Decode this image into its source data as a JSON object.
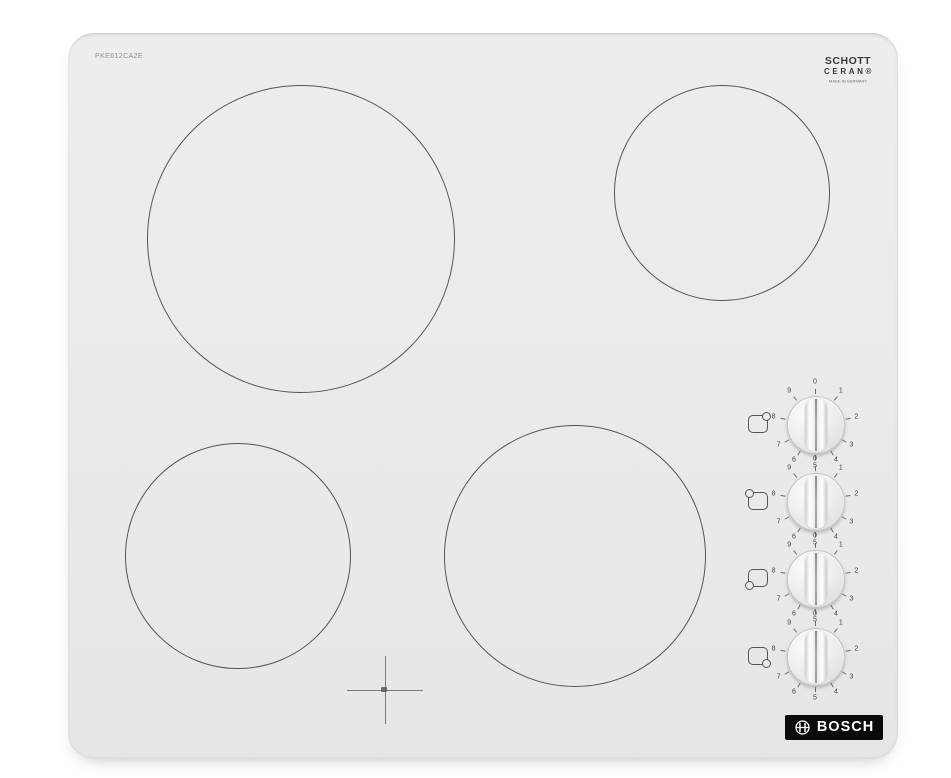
{
  "product": {
    "model_code": "PKE612CA2E",
    "type": "ceramic glass cooktop"
  },
  "branding": {
    "schott": {
      "line1": "SCHOTT",
      "line2": "CERAN®",
      "subtext": "MADE IN GERMANY"
    },
    "bosch": {
      "label": "BOSCH"
    }
  },
  "colors": {
    "page_bg": "#ffffff",
    "hob_surface": "#e9eae9",
    "zone_outline": "#303030",
    "dial_text": "#414141",
    "logo_bg": "#0b0b0b",
    "logo_text": "#ffffff"
  },
  "dial": {
    "numbers": [
      "0",
      "1",
      "2",
      "3",
      "4",
      "5",
      "6",
      "7",
      "8",
      "9"
    ],
    "angles_deg": [
      0,
      38,
      80,
      120,
      150,
      180,
      210,
      240,
      280,
      322
    ],
    "off_label": "0"
  },
  "knobs": [
    {
      "zone": "back right",
      "indicator_corner": "top-right",
      "position": "0"
    },
    {
      "zone": "back left",
      "indicator_corner": "top-left",
      "position": "0"
    },
    {
      "zone": "front left",
      "indicator_corner": "bottom-left",
      "position": "0"
    },
    {
      "zone": "front right",
      "indicator_corner": "bottom-right",
      "position": "0"
    }
  ],
  "zones": [
    {
      "name": "back-left",
      "size": "large"
    },
    {
      "name": "back-right",
      "size": "medium"
    },
    {
      "name": "front-left",
      "size": "medium"
    },
    {
      "name": "front-right",
      "size": "large"
    }
  ]
}
